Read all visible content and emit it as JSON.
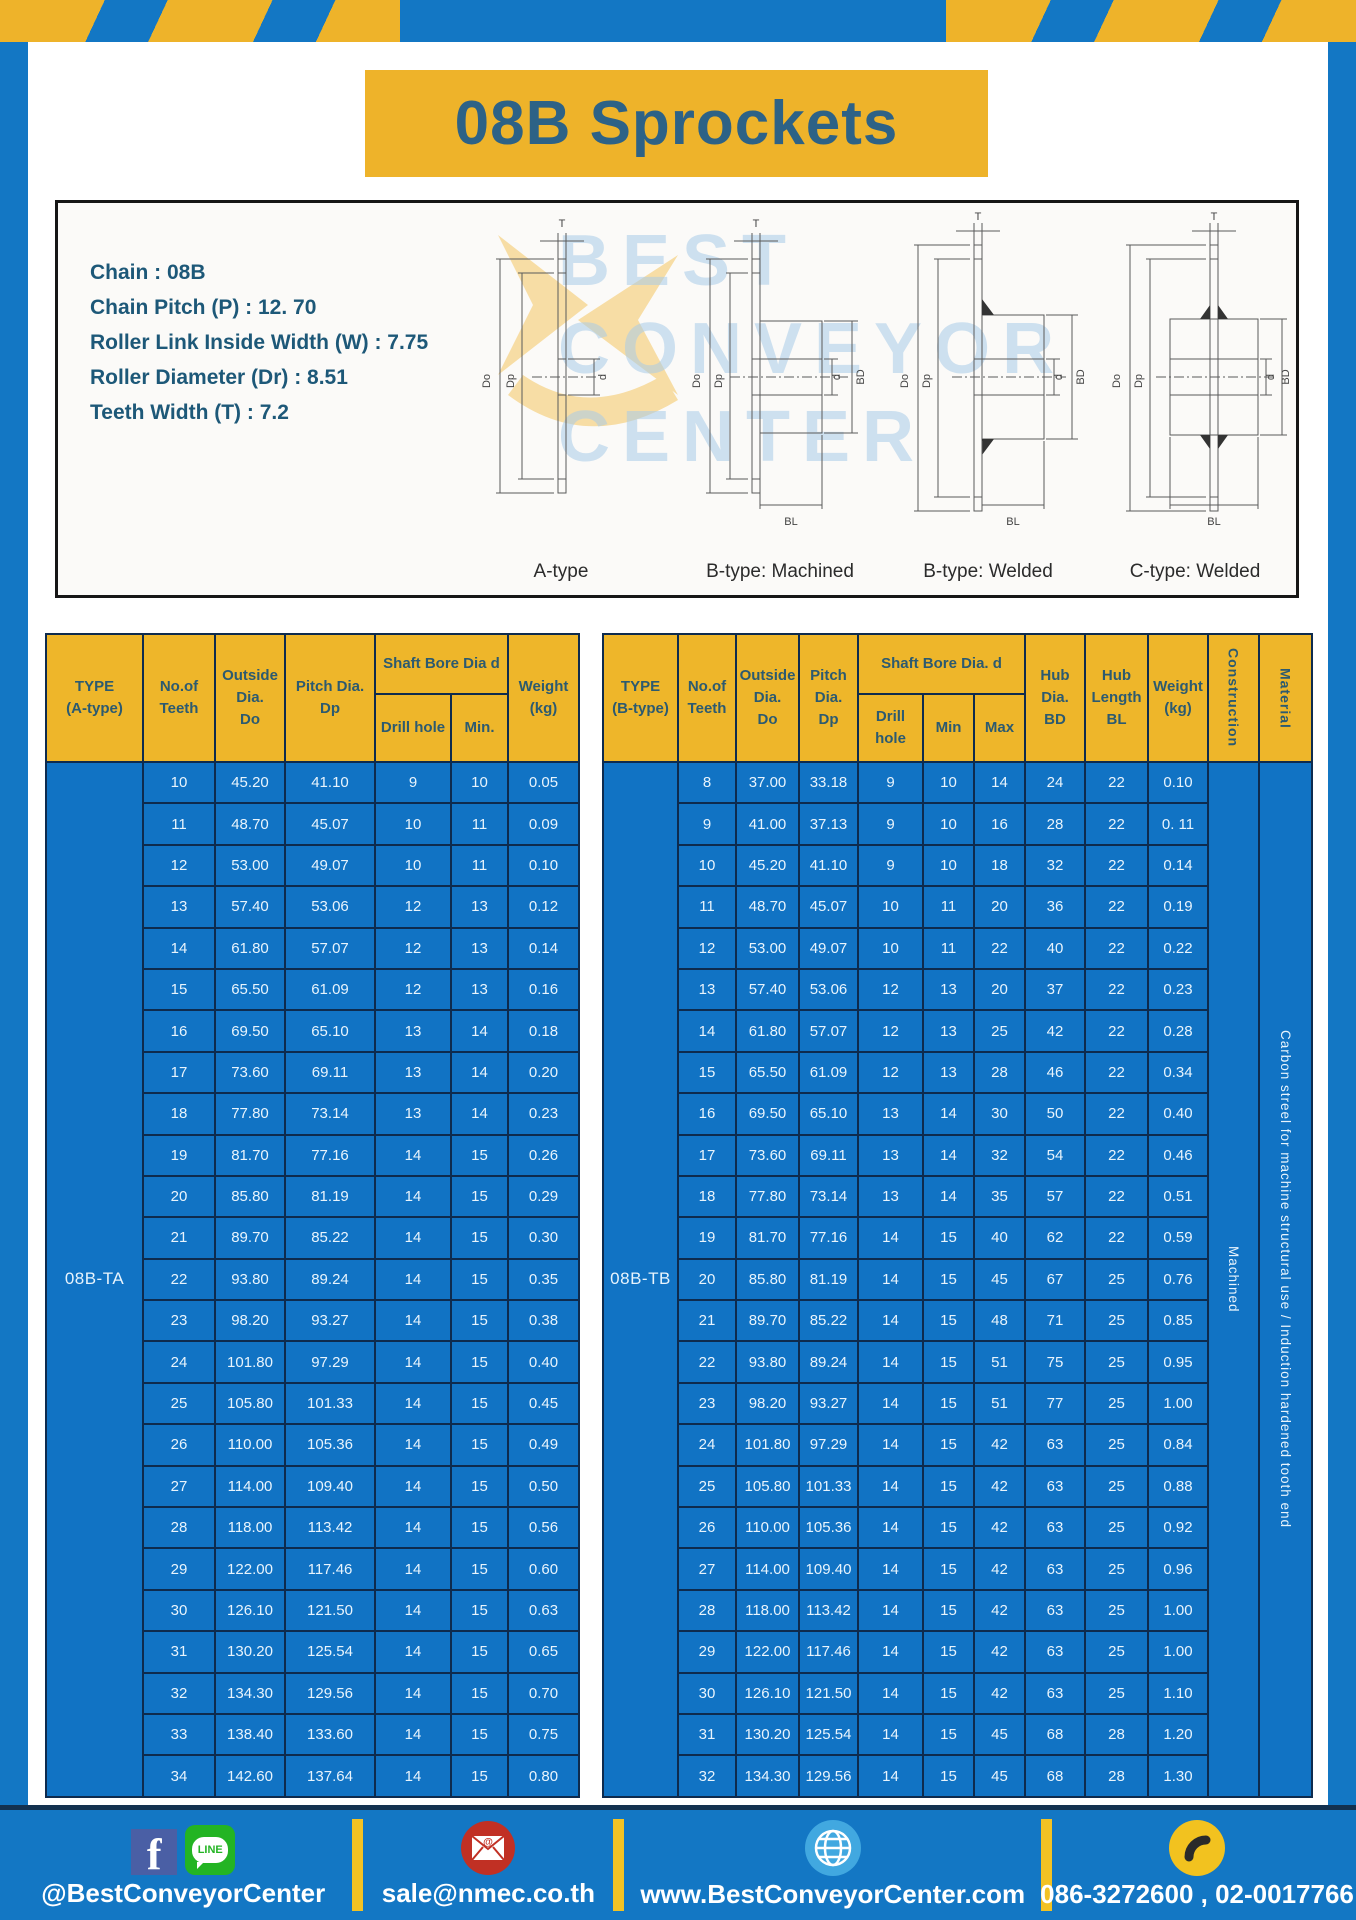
{
  "page": {
    "title": "08B Sprockets"
  },
  "colors": {
    "frame_blue": "#1377c4",
    "gold": "#eeb32a",
    "table_blue": "#1173c4",
    "border_navy": "#0e2b4e",
    "title_text": "#2d6286",
    "spec_text": "#1d5878"
  },
  "specs": {
    "lines": [
      "Chain  : 08B",
      "Chain Pitch (P)  :  12. 70",
      "Roller Link Inside Width (W)  :  7.75",
      "Roller Diameter (Dr)  : 8.51",
      "Teeth Width (T)  :  7.2"
    ]
  },
  "diagram": {
    "captions": [
      "A-type",
      "B-type: Machined",
      "B-type: Welded",
      "C-type: Welded"
    ],
    "watermark_lines": [
      "BEST",
      "CONVEYOR",
      "CENTER"
    ],
    "dims": {
      "T": "T",
      "Do": "Do",
      "Dp": "Dp",
      "d": "d",
      "BD": "BD",
      "BL": "BL"
    }
  },
  "table_a": {
    "type_label": "08B-TA",
    "headers": {
      "type": "TYPE\n(A-type)",
      "teeth": "No.of\nTeeth",
      "outside": "Outside\nDia.\nDo",
      "pitch": "Pitch Dia.\nDp",
      "shaft_bore": "Shaft Bore Dia d",
      "drill": "Drill hole",
      "min": "Min.",
      "weight": "Weight\n(kg)"
    },
    "rows": [
      [
        "10",
        "45.20",
        "41.10",
        "9",
        "10",
        "0.05"
      ],
      [
        "11",
        "48.70",
        "45.07",
        "10",
        "11",
        "0.09"
      ],
      [
        "12",
        "53.00",
        "49.07",
        "10",
        "11",
        "0.10"
      ],
      [
        "13",
        "57.40",
        "53.06",
        "12",
        "13",
        "0.12"
      ],
      [
        "14",
        "61.80",
        "57.07",
        "12",
        "13",
        "0.14"
      ],
      [
        "15",
        "65.50",
        "61.09",
        "12",
        "13",
        "0.16"
      ],
      [
        "16",
        "69.50",
        "65.10",
        "13",
        "14",
        "0.18"
      ],
      [
        "17",
        "73.60",
        "69.11",
        "13",
        "14",
        "0.20"
      ],
      [
        "18",
        "77.80",
        "73.14",
        "13",
        "14",
        "0.23"
      ],
      [
        "19",
        "81.70",
        "77.16",
        "14",
        "15",
        "0.26"
      ],
      [
        "20",
        "85.80",
        "81.19",
        "14",
        "15",
        "0.29"
      ],
      [
        "21",
        "89.70",
        "85.22",
        "14",
        "15",
        "0.30"
      ],
      [
        "22",
        "93.80",
        "89.24",
        "14",
        "15",
        "0.35"
      ],
      [
        "23",
        "98.20",
        "93.27",
        "14",
        "15",
        "0.38"
      ],
      [
        "24",
        "101.80",
        "97.29",
        "14",
        "15",
        "0.40"
      ],
      [
        "25",
        "105.80",
        "101.33",
        "14",
        "15",
        "0.45"
      ],
      [
        "26",
        "110.00",
        "105.36",
        "14",
        "15",
        "0.49"
      ],
      [
        "27",
        "114.00",
        "109.40",
        "14",
        "15",
        "0.50"
      ],
      [
        "28",
        "118.00",
        "113.42",
        "14",
        "15",
        "0.56"
      ],
      [
        "29",
        "122.00",
        "117.46",
        "14",
        "15",
        "0.60"
      ],
      [
        "30",
        "126.10",
        "121.50",
        "14",
        "15",
        "0.63"
      ],
      [
        "31",
        "130.20",
        "125.54",
        "14",
        "15",
        "0.65"
      ],
      [
        "32",
        "134.30",
        "129.56",
        "14",
        "15",
        "0.70"
      ],
      [
        "33",
        "138.40",
        "133.60",
        "14",
        "15",
        "0.75"
      ],
      [
        "34",
        "142.60",
        "137.64",
        "14",
        "15",
        "0.80"
      ]
    ]
  },
  "table_b": {
    "type_label": "08B-TB",
    "construction": "Machined",
    "material": "Carbon streel for machine structural use / Induction hardened tooth end",
    "headers": {
      "type": "TYPE\n(B-type)",
      "teeth": "No.of\nTeeth",
      "outside": "Outside\nDia.\nDo",
      "pitch": "Pitch\nDia.\nDp",
      "shaft_bore": "Shaft Bore Dia.  d",
      "drill": "Drill hole",
      "min": "Min",
      "max": "Max",
      "hub_dia": "Hub\nDia.\nBD",
      "hub_len": "Hub\nLength\nBL",
      "weight": "Weight\n(kg)",
      "construction": "Construction",
      "material": "Material"
    },
    "rows": [
      [
        "8",
        "37.00",
        "33.18",
        "9",
        "10",
        "14",
        "24",
        "22",
        "0.10"
      ],
      [
        "9",
        "41.00",
        "37.13",
        "9",
        "10",
        "16",
        "28",
        "22",
        "0. 11"
      ],
      [
        "10",
        "45.20",
        "41.10",
        "9",
        "10",
        "18",
        "32",
        "22",
        "0.14"
      ],
      [
        "11",
        "48.70",
        "45.07",
        "10",
        "11",
        "20",
        "36",
        "22",
        "0.19"
      ],
      [
        "12",
        "53.00",
        "49.07",
        "10",
        "11",
        "22",
        "40",
        "22",
        "0.22"
      ],
      [
        "13",
        "57.40",
        "53.06",
        "12",
        "13",
        "20",
        "37",
        "22",
        "0.23"
      ],
      [
        "14",
        "61.80",
        "57.07",
        "12",
        "13",
        "25",
        "42",
        "22",
        "0.28"
      ],
      [
        "15",
        "65.50",
        "61.09",
        "12",
        "13",
        "28",
        "46",
        "22",
        "0.34"
      ],
      [
        "16",
        "69.50",
        "65.10",
        "13",
        "14",
        "30",
        "50",
        "22",
        "0.40"
      ],
      [
        "17",
        "73.60",
        "69.11",
        "13",
        "14",
        "32",
        "54",
        "22",
        "0.46"
      ],
      [
        "18",
        "77.80",
        "73.14",
        "13",
        "14",
        "35",
        "57",
        "22",
        "0.51"
      ],
      [
        "19",
        "81.70",
        "77.16",
        "14",
        "15",
        "40",
        "62",
        "22",
        "0.59"
      ],
      [
        "20",
        "85.80",
        "81.19",
        "14",
        "15",
        "45",
        "67",
        "25",
        "0.76"
      ],
      [
        "21",
        "89.70",
        "85.22",
        "14",
        "15",
        "48",
        "71",
        "25",
        "0.85"
      ],
      [
        "22",
        "93.80",
        "89.24",
        "14",
        "15",
        "51",
        "75",
        "25",
        "0.95"
      ],
      [
        "23",
        "98.20",
        "93.27",
        "14",
        "15",
        "51",
        "77",
        "25",
        "1.00"
      ],
      [
        "24",
        "101.80",
        "97.29",
        "14",
        "15",
        "42",
        "63",
        "25",
        "0.84"
      ],
      [
        "25",
        "105.80",
        "101.33",
        "14",
        "15",
        "42",
        "63",
        "25",
        "0.88"
      ],
      [
        "26",
        "110.00",
        "105.36",
        "14",
        "15",
        "42",
        "63",
        "25",
        "0.92"
      ],
      [
        "27",
        "114.00",
        "109.40",
        "14",
        "15",
        "42",
        "63",
        "25",
        "0.96"
      ],
      [
        "28",
        "118.00",
        "113.42",
        "14",
        "15",
        "42",
        "63",
        "25",
        "1.00"
      ],
      [
        "29",
        "122.00",
        "117.46",
        "14",
        "15",
        "42",
        "63",
        "25",
        "1.00"
      ],
      [
        "30",
        "126.10",
        "121.50",
        "14",
        "15",
        "42",
        "63",
        "25",
        "1.10"
      ],
      [
        "31",
        "130.20",
        "125.54",
        "14",
        "15",
        "45",
        "68",
        "28",
        "1.20"
      ],
      [
        "32",
        "134.30",
        "129.56",
        "14",
        "15",
        "45",
        "68",
        "28",
        "1.30"
      ]
    ]
  },
  "footer": {
    "social_label": "@BestConveyorCenter",
    "line_badge": "LINE",
    "email": "sale@nmec.co.th",
    "website": "www.BestConveyorCenter.com",
    "phone": "086-3272600 , 02-0017766"
  }
}
